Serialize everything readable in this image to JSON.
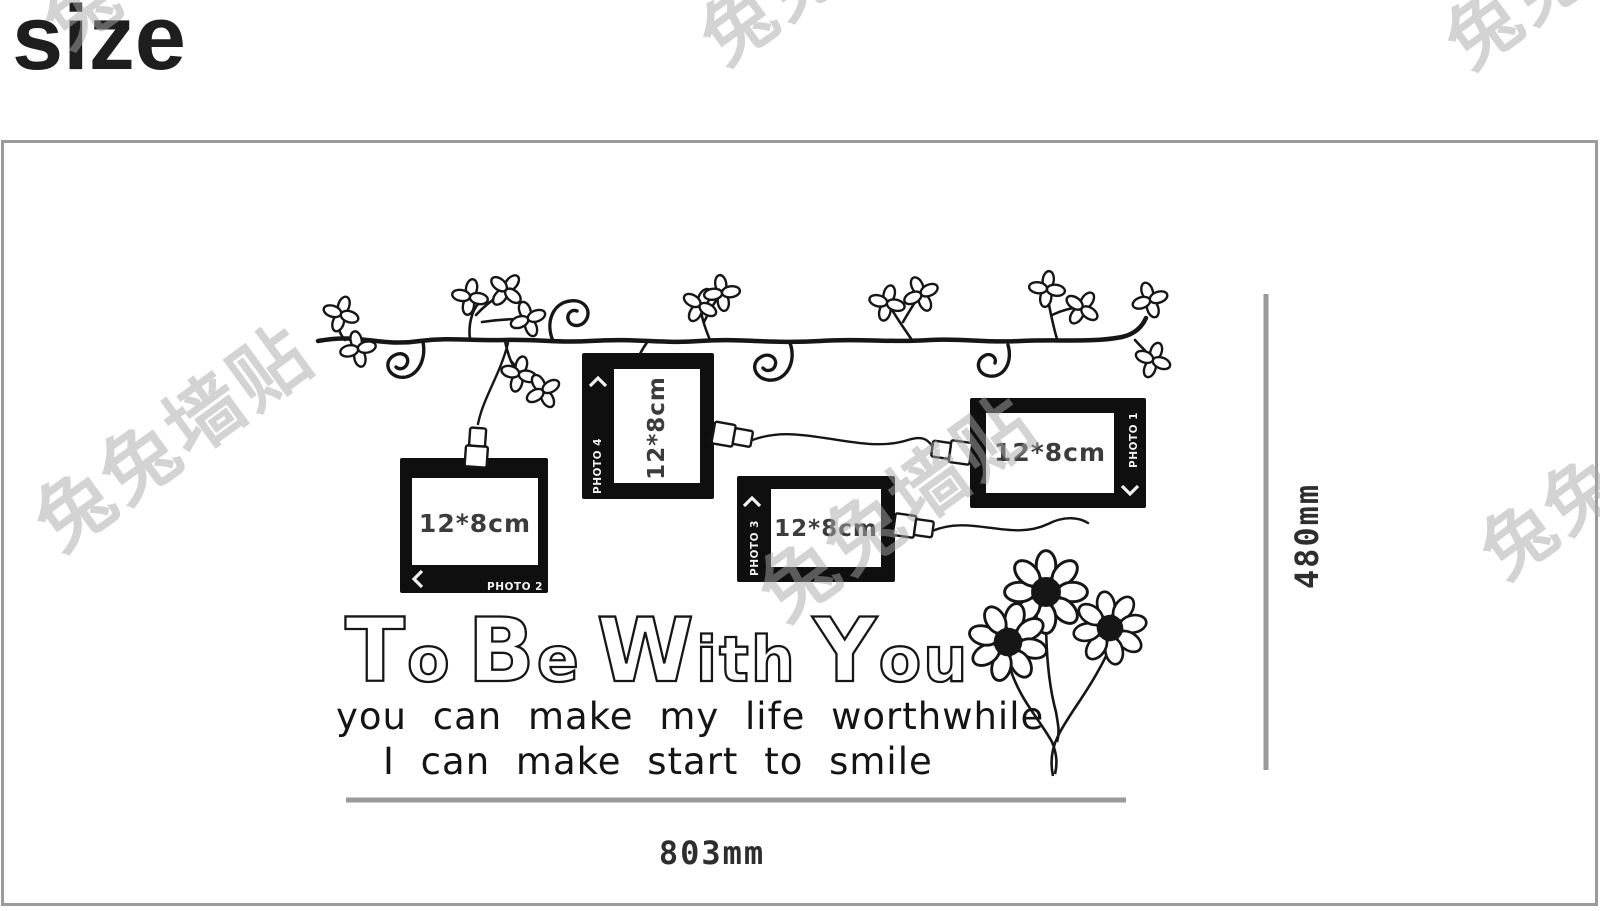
{
  "page": {
    "title": "size"
  },
  "decal": {
    "frames": [
      {
        "size_label": "12*8cm",
        "photo_tag": "PHOTO 2"
      },
      {
        "size_label": "12*8cm",
        "photo_tag": "PHOTO 4"
      },
      {
        "size_label": "12*8cm",
        "photo_tag": "PHOTO 3"
      },
      {
        "size_label": "12*8cm",
        "photo_tag": "PHOTO 1"
      }
    ],
    "headline": {
      "words": [
        {
          "cap": "T",
          "rest": "o"
        },
        {
          "cap": "B",
          "rest": "e"
        },
        {
          "cap": "W",
          "rest": "ith"
        },
        {
          "cap": "Y",
          "rest": "ou"
        }
      ]
    },
    "subtext_line1": "you can make my life worthwhile",
    "subtext_line2": "I can make start to smile"
  },
  "dimensions": {
    "width": "803mm",
    "height": "480mm"
  },
  "watermark": {
    "full": "兔兔墙贴",
    "partial": "兔兔",
    "char": "兔"
  },
  "colors": {
    "ink": "#161616",
    "frame_black": "#0f0f0f",
    "frame_label": "#3c3c3c",
    "dimension_line": "#9a9a9a",
    "border_gray": "#9b9b9b",
    "watermark_gray": "#a8a8a8"
  }
}
